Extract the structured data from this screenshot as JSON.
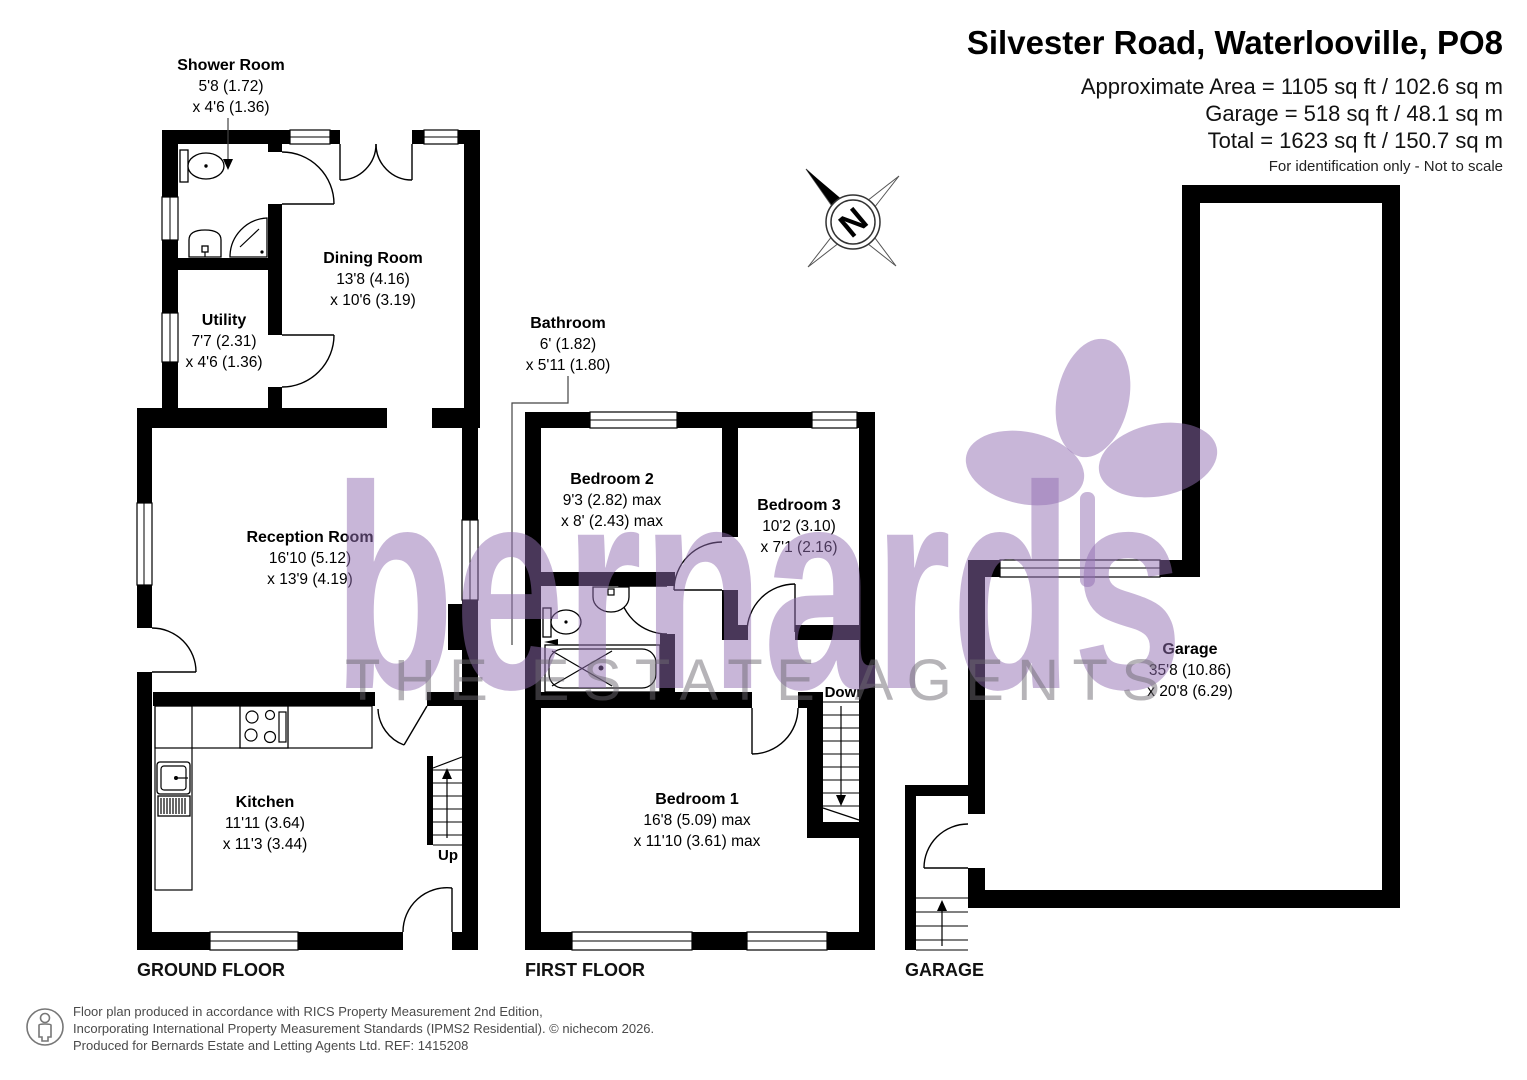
{
  "header": {
    "title": "Silvester Road, Waterlooville, PO8",
    "area_total_line": "Approximate Area = 1105 sq ft / 102.6 sq m",
    "area_garage_line": "Garage = 518 sq ft / 48.1 sq m",
    "area_sum_line": "Total = 1623 sq ft / 150.7 sq m",
    "disclaimer": "For identification only - Not to scale"
  },
  "floors": {
    "ground_label": "GROUND FLOOR",
    "first_label": "FIRST FLOOR",
    "garage_label": "GARAGE"
  },
  "rooms": {
    "shower": {
      "name": "Shower Room",
      "dim1": "5'8 (1.72)",
      "dim2": "x 4'6 (1.36)"
    },
    "dining": {
      "name": "Dining Room",
      "dim1": "13'8 (4.16)",
      "dim2": "x 10'6 (3.19)"
    },
    "utility": {
      "name": "Utility",
      "dim1": "7'7 (2.31)",
      "dim2": "x 4'6 (1.36)"
    },
    "reception": {
      "name": "Reception Room",
      "dim1": "16'10 (5.12)",
      "dim2": "x 13'9 (4.19)"
    },
    "kitchen": {
      "name": "Kitchen",
      "dim1": "11'11 (3.64)",
      "dim2": "x 11'3 (3.44)"
    },
    "bathroom": {
      "name": "Bathroom",
      "dim1": "6' (1.82)",
      "dim2": "x 5'11 (1.80)"
    },
    "bedroom2": {
      "name": "Bedroom 2",
      "dim1": "9'3 (2.82) max",
      "dim2": "x 8' (2.43) max"
    },
    "bedroom3": {
      "name": "Bedroom 3",
      "dim1": "10'2 (3.10)",
      "dim2": "x 7'1 (2.16)"
    },
    "bedroom1": {
      "name": "Bedroom 1",
      "dim1": "16'8 (5.09) max",
      "dim2": "x 11'10 (3.61) max"
    },
    "garage": {
      "name": "Garage",
      "dim1": "35'8 (10.86)",
      "dim2": "x 20'8 (6.29)"
    }
  },
  "stairs": {
    "up": "Up",
    "down": "Down"
  },
  "compass": {
    "north": "N"
  },
  "watermark": {
    "brand": "bernards",
    "tagline": "THE ESTATE AGENTS"
  },
  "footer": {
    "line1": "Floor plan produced in accordance with RICS Property Measurement 2nd Edition,",
    "line2": "Incorporating International Property Measurement Standards (IPMS2 Residential).   © nichecom 2026.",
    "line3": "Produced for Bernards Estate and Letting Agents Ltd.   REF:  1415208"
  },
  "colors": {
    "walls": "#000000",
    "watermark_purple": "#c8b6d8",
    "watermark_gray": "#b6b4b8",
    "footer_text": "#4a4a4a"
  }
}
